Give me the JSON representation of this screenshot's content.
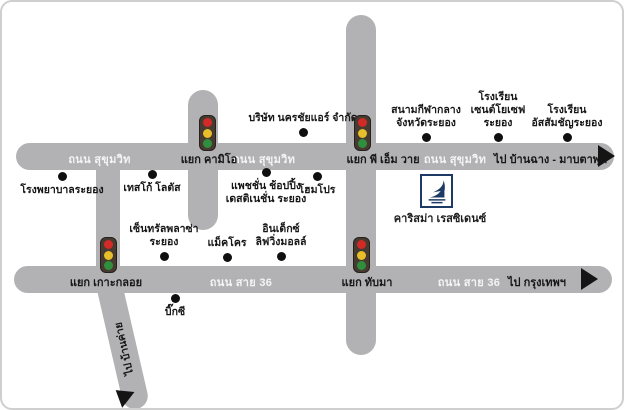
{
  "map": {
    "road_labels": {
      "sukhumvit_left": "ถนน สุขุมวิท",
      "sukhumvit_mid": "ถนน สุขุมวิท",
      "sukhumvit_right": "ถนน สุขุมวิท",
      "route36_left": "ถนน สาย 36",
      "route36_right": "ถนน สาย 36"
    },
    "intersections": {
      "kameo": "แยก คามิโอ",
      "pmy": "แยก พี เอ็ม วาย",
      "koh_kloi": "แยก เกาะกลอย",
      "thap_ma": "แยก ทับมา"
    },
    "destinations": {
      "ban_chang_maptaphut": "ไป บ้านฉาง - มาบตาพุด",
      "bangkok": "ไป กรุงเทพฯ",
      "ban_khai": "ไป บ้านค่าย"
    },
    "pois": {
      "nakhonchai_air": "บริษัท นครชัยแอร์ จำกัด",
      "stadium": "สนามกีฬากลาง\nจังหวัดระยอง",
      "st_joseph_school": "โรงเรียน\nเซนต์โยเซฟ\nระยอง",
      "assumption_school": "โรงเรียน\nอัสสัมชัญระยอง",
      "rayong_hospital": "โรงพยาบาลระยอง",
      "tesco_lotus": "เทสโก้ โลตัส",
      "passione_shopping": "แพชชั่น ช้อปปิ้ง\nเดสติเนชั่น ระยอง",
      "homepro": "โฮมโปร",
      "central_plaza": "เซ็นทรัลพลาซ่า\nระยอง",
      "makro": "แม็คโคร",
      "index_living_mall": "อินเด็กซ์\nลิฟวิ่งมอลล์",
      "big_c": "บิ๊กซี",
      "charisma_residence": "คาริสม่า เรสซิเดนซ์"
    },
    "colors": {
      "road": "#b2b2b4",
      "road_text": "#f4f4f4",
      "text": "#161616",
      "logo_navy": "#1d3a66",
      "light_red": "#d22a26",
      "light_yellow": "#e6bf2b",
      "light_green": "#2f8f3c"
    }
  }
}
